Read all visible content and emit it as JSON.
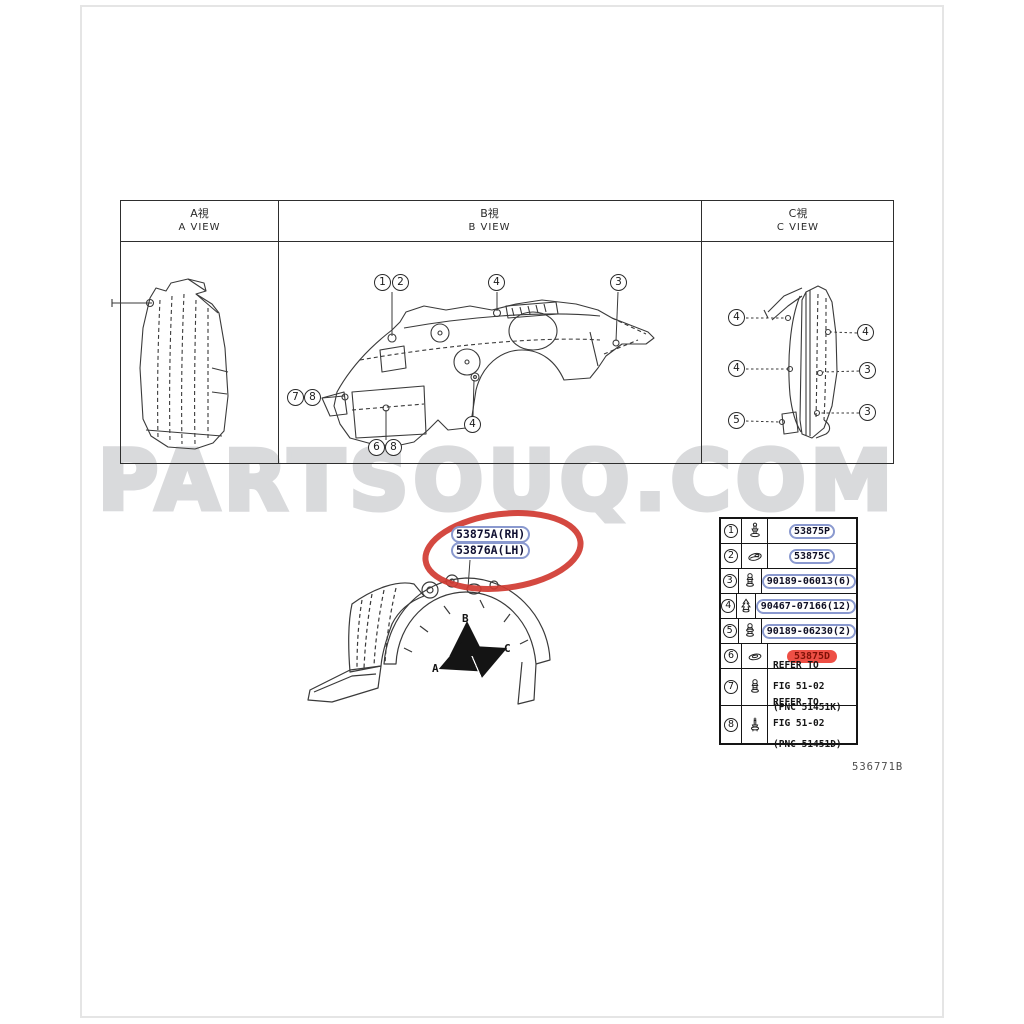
{
  "page": {
    "watermark": "PARTSOUQ.COM",
    "figure_code": "536771B"
  },
  "views_table": {
    "columns": [
      {
        "jp": "A視",
        "en": "A VIEW"
      },
      {
        "jp": "B視",
        "en": "B VIEW"
      },
      {
        "jp": "C視",
        "en": "C VIEW"
      }
    ]
  },
  "callouts": {
    "b": [
      "1",
      "2",
      "4",
      "3",
      "7",
      "8",
      "4",
      "6",
      "8"
    ],
    "c": [
      "4",
      "4",
      "4",
      "3",
      "5",
      "3"
    ]
  },
  "highlight": {
    "labels": [
      "53875A(RH)",
      "53876A(LH)"
    ]
  },
  "arrows": {
    "a": "A",
    "b": "B",
    "c": "C"
  },
  "parts_table": {
    "rows": [
      {
        "no": "1",
        "icon": "pin-clip",
        "part": "53875P"
      },
      {
        "no": "2",
        "icon": "flat-clip",
        "part": "53875C"
      },
      {
        "no": "3",
        "icon": "rivet-clip",
        "part": "90189-06013(6)"
      },
      {
        "no": "4",
        "icon": "tree-clip",
        "part": "90467-07166(12)"
      },
      {
        "no": "5",
        "icon": "rivet-clip",
        "part": "90189-06230(2)"
      },
      {
        "no": "6",
        "icon": "grommet-clip",
        "part": "53875D",
        "highlight": "red"
      },
      {
        "no": "7",
        "icon": "rivet-clip",
        "lines": [
          "REFER TO",
          "FIG 51-02",
          "(PNC 51451K)"
        ]
      },
      {
        "no": "8",
        "icon": "screw-pin",
        "lines": [
          "REFER TO",
          "FIG 51-02",
          "(PNC 51451D)"
        ]
      }
    ]
  },
  "colors": {
    "accent_red": "#d03a31",
    "highlight_fill": "#ee4f45",
    "link_oval_blue": "#8a99cf",
    "watermark_gray": "#d9dadc"
  }
}
